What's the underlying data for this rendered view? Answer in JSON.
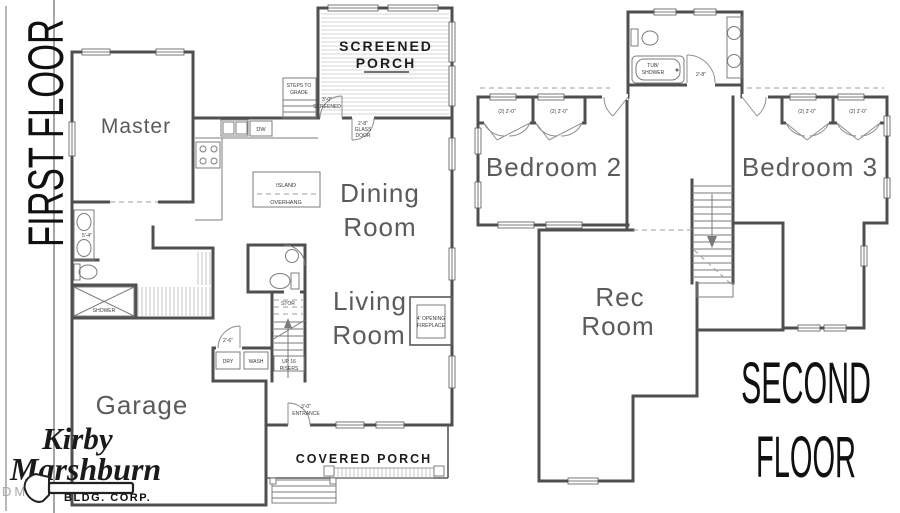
{
  "sheet": {
    "background": "#ffffff"
  },
  "colors": {
    "wall": "#4f4f4f",
    "room_label": "#5b5b5e",
    "ink": "#1d1d1d",
    "hatch": "#d6d6d6"
  },
  "first_floor": {
    "title": "FIRST FLOOR",
    "rooms": {
      "master": "Master",
      "dining_1": "Dining",
      "dining_2": "Room",
      "living_1": "Living",
      "living_2": "Room",
      "garage": "Garage",
      "screened_porch_1": "SCREENED",
      "screened_porch_2": "PORCH",
      "covered_porch": "COVERED PORCH"
    },
    "annotations": {
      "steps_1": "STEPS TO",
      "steps_2": "GRADE",
      "screen_door_1": "3'-0\"",
      "screen_door_2": "SCREENED",
      "glass_door_1": "2'-8\"",
      "glass_door_2": "GLASS",
      "glass_door_3": "DOOR",
      "island": "ISLAND",
      "overhang": "OVERHANG",
      "dishwasher": "DW",
      "vanity_dim": "5'-4\"",
      "shower": "SHOWER",
      "storage": "STOR",
      "up_1": "UP 16",
      "up_2": "RISERS",
      "dryer": "DRY",
      "washer": "WASH",
      "laundry_door": "2'-6\"",
      "fireplace_1": "4' OPENING",
      "fireplace_2": "FIREPLACE",
      "entry_1": "3'-0\"",
      "entry_2": "ENTRANCE"
    }
  },
  "second_floor": {
    "title_1": "SECOND",
    "title_2": "FLOOR",
    "rooms": {
      "bedroom2": "Bedroom 2",
      "bedroom3": "Bedroom 3",
      "rec_1": "Rec",
      "rec_2": "Room"
    },
    "annotations": {
      "tub_1": "TUB/",
      "tub_2": "SHOWER",
      "bath_door": "2'-8\"",
      "closet": "(2) 2'-0\""
    }
  },
  "branding": {
    "name_1": "Kirby",
    "name_2": "Marshburn",
    "name_3": "BLDG. CORP.",
    "watermark": "DMLS"
  }
}
